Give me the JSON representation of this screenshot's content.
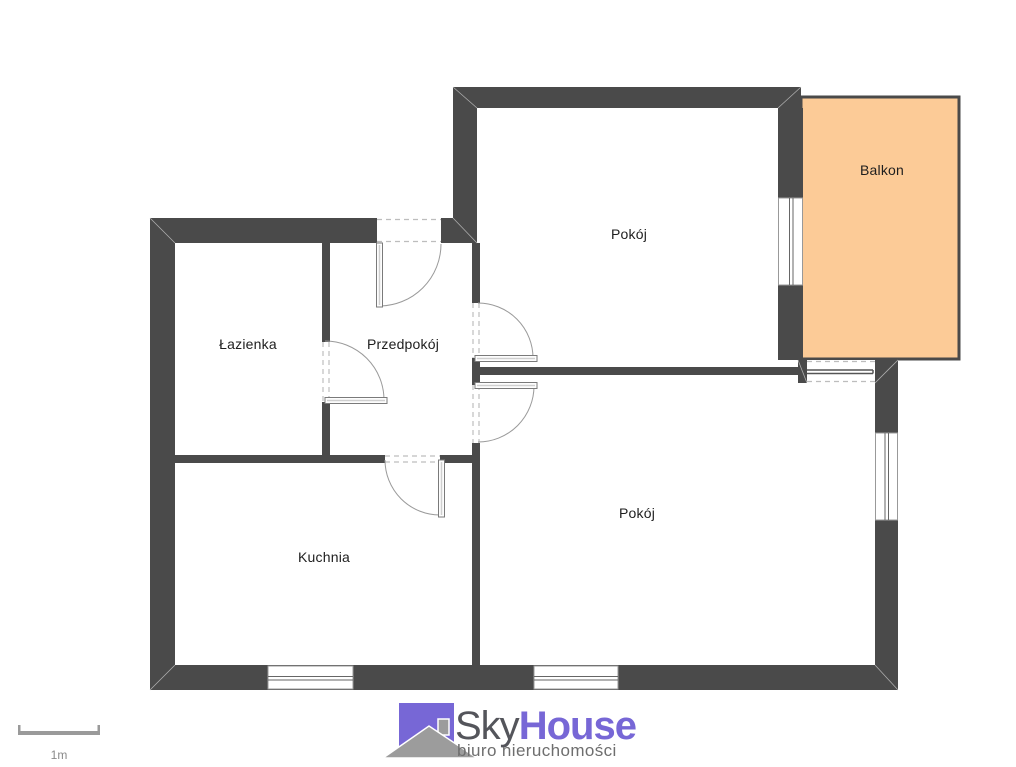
{
  "plan": {
    "rooms": {
      "lazienka": "Łazienka",
      "przedpokoj": "Przedpokój",
      "pokoj_gorny": "Pokój",
      "pokoj_dolny": "Pokój",
      "kuchnia": "Kuchnia",
      "balkon": "Balkon"
    },
    "scale_label": "1m"
  },
  "branding": {
    "name_part1": "Sky",
    "name_part2": "House",
    "tagline": "biuro nieruchomości"
  },
  "colors": {
    "wall": "#4A4A4A",
    "balcony-fill": "#FCCB97",
    "logo-purple": "#7767D6",
    "logo-roof-gray": "#9C9C9C",
    "text-dark": "#1E1E1E",
    "text-gray": "#6E6E6E",
    "scale-gray": "#9A9A9A"
  }
}
